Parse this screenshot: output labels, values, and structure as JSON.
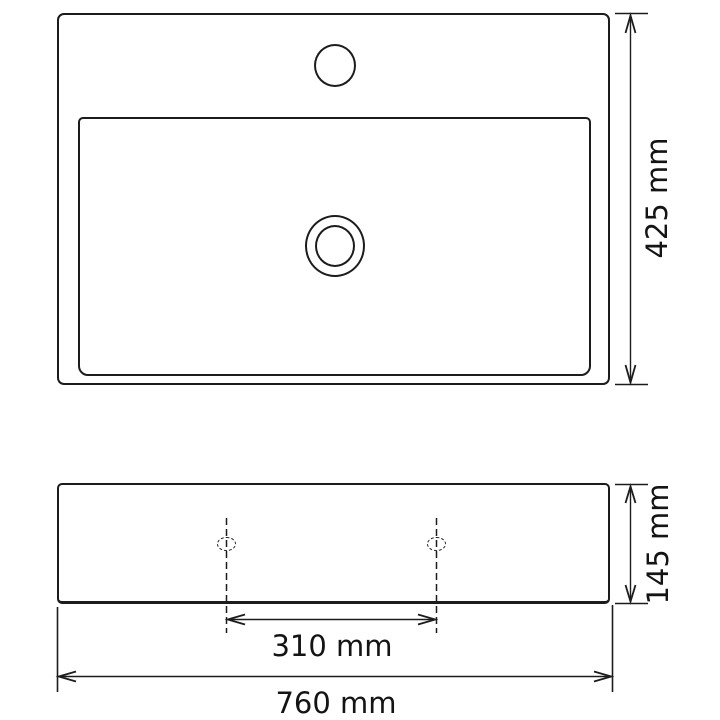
{
  "drawing": {
    "background_color": "#ffffff",
    "line_color": "#1c1c1c"
  },
  "dimensions": {
    "top_height_label": "425 mm",
    "front_height_label": "145 mm",
    "hole_spacing_label": "310 mm",
    "width_label": "760 mm"
  }
}
